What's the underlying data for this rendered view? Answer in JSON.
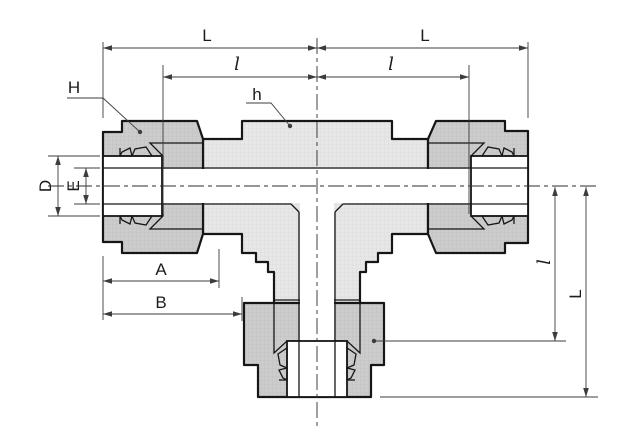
{
  "drawing": {
    "title": "tee-tube-fitting-cross-section",
    "background": "#ffffff",
    "outline_color": "#161616",
    "dimension_color": "#3c3c3c",
    "body_fill": "#e7e7e7",
    "nut_fill": "#cdcdcd",
    "bore_fill": "#ffffff"
  },
  "labels": {
    "L_top_left": "L",
    "l_top_left": "l",
    "l_top_right": "l",
    "L_top_right": "L",
    "H_nut": "H",
    "h_body": "h",
    "D_tube": "D",
    "E_bore": "E",
    "A_bottom": "A",
    "B_bottom": "B",
    "l_right": "l",
    "L_right": "L"
  }
}
